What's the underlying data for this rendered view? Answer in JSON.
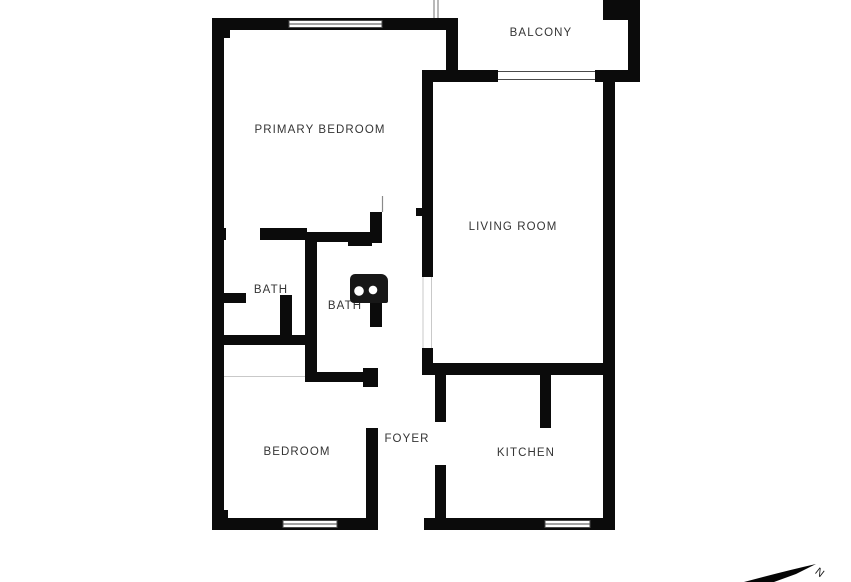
{
  "colors": {
    "background": "#ffffff",
    "walls": "#0b0b0b",
    "labels": "#353535"
  },
  "rooms": [
    {
      "name": "primary-bedroom",
      "label": "PRIMARY BEDROOM"
    },
    {
      "name": "balcony",
      "label": "BALCONY"
    },
    {
      "name": "living-room",
      "label": "LIVING ROOM"
    },
    {
      "name": "bath-1",
      "label": "BATH"
    },
    {
      "name": "bath-2",
      "label": "BATH"
    },
    {
      "name": "bedroom",
      "label": "BEDROOM"
    },
    {
      "name": "foyer",
      "label": "FOYER"
    },
    {
      "name": "kitchen",
      "label": "KITCHEN"
    }
  ],
  "compass": {
    "label": "N"
  }
}
